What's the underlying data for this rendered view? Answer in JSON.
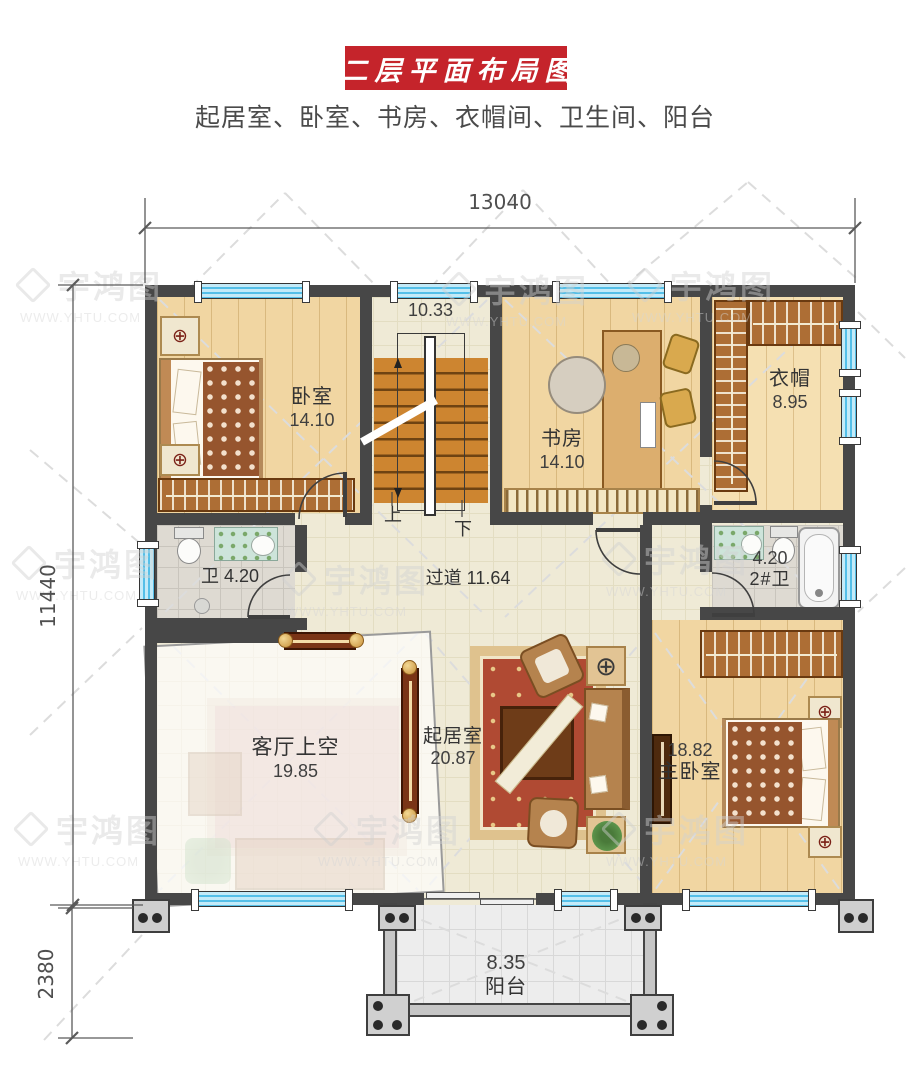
{
  "header": {
    "title": "二层平面布局图",
    "subtitle": "起居室、卧室、书房、衣帽间、卫生间、阳台"
  },
  "dims": {
    "top": "13040",
    "left": "11440",
    "left_bottom": "2380"
  },
  "rooms": {
    "bedroom": {
      "name": "卧室",
      "area": "14.10"
    },
    "stairwell": {
      "area": "10.33",
      "up": "上",
      "down": "下"
    },
    "study": {
      "name": "书房",
      "area": "14.10"
    },
    "cloakroom": {
      "name": "衣帽",
      "area": "8.95"
    },
    "bath1": {
      "name": "卫",
      "area": "4.20"
    },
    "corridor": {
      "name": "过道",
      "area": "11.64"
    },
    "bath2": {
      "name": "2#卫",
      "area": "4.20"
    },
    "living_void": {
      "name": "客厅上空",
      "area": "19.85"
    },
    "family_room": {
      "name": "起居室",
      "area": "20.87"
    },
    "master_bedroom": {
      "name": "主卧室",
      "area": "18.82"
    },
    "balcony": {
      "name": "阳台",
      "area": "8.35"
    }
  },
  "watermark": {
    "brand": "宇鸿图",
    "url": "WWW.YHTU.COM"
  },
  "icons": {
    "compass": "⊕"
  },
  "colors": {
    "banner_red": "#c5242b",
    "wall_gray": "#474747",
    "window_blue": "#54bfe8",
    "wood_floor": "#f1d6a2",
    "tile_beige": "#efead6",
    "stair_orange": "#cd8530",
    "carpet_red": "#b04a33"
  }
}
